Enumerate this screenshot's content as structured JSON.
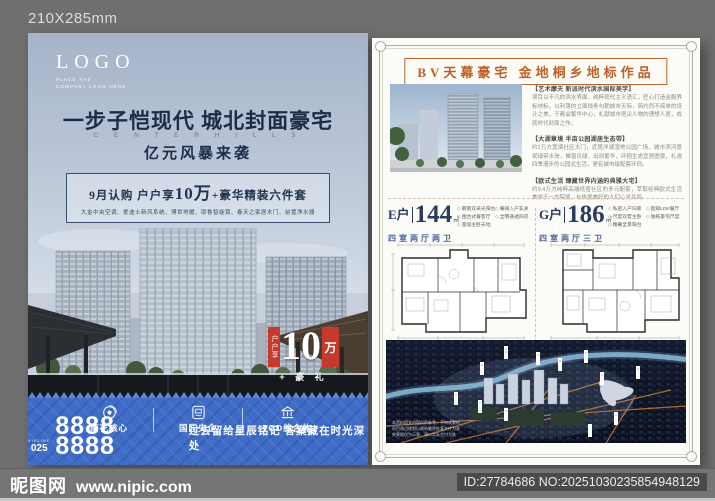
{
  "page": {
    "size_label": "210X285mm"
  },
  "watermark": {
    "brand": "昵图网",
    "url": "www.nipic.com",
    "id_text": "ID:27784686 NO:20251030235854948129"
  },
  "poster": {
    "logo": {
      "text": "LOGO",
      "sub_line1": "PLACE THE",
      "sub_line2": "COMPANY LOGO HERE"
    },
    "headline": "一步子恺现代 城北封面豪宅",
    "subhead_en": "C E N T E R  H I L L S",
    "slogan": "亿元风暴来袭",
    "offer": {
      "prefix": "9月认购 户户享",
      "big": "10万",
      "suffix": "+豪华精装六件套",
      "details": "大金中央空调、爱迪士新风系统、博世地暖、耶鲁智能锁、春天之家居木门、前置净水器"
    },
    "badge": {
      "vertical": "户户享",
      "number": "10",
      "unit": "万",
      "suffix": "+ 豪 礼"
    },
    "footer": {
      "features": [
        "雨花核心",
        "国匠央企",
        "TOD综合体"
      ],
      "hotline_label": "VIPLINE",
      "area_code": "025",
      "phone": "8888 8888",
      "tagline": "过去留给星辰铭记 答案藏在时光深处"
    }
  },
  "flyer": {
    "header": "BV天幕豪宅 金地桐乡地标作品",
    "sections": [
      {
        "title": "【艺术摩天 新派时代滨水国际美学】",
        "body": "项目以不凡的滨水界面、纯粹现代主义语汇，匠心打造金服界标地标，以利落的立面线条勾勒城市天际，简约而不简单的设计之美，于都会繁华中心，礼献城市塔尖人物的理想人居，成就时代封面之作。"
      },
      {
        "title": "【大湖章境 半亩公园湖居生态带】",
        "body": "约2万方宽境社区大门，近揽洋湖湿地公园广场、城市滨河景观绿带水岸，推窗见绿、出则繁华，环抱生态宜居图景，礼遇四季漫步的公园式生活，更有城市级配套环伺。"
      },
      {
        "title": "【欧式生活 臻藏世界内涵的典雅大宅】",
        "body": "约9.4万方纯粹高端低密社区的多元配套，萃取经典欧式生活美学于一方院境，与热爱美好的人们心灵共鸣。"
      }
    ],
    "units": [
      {
        "name": "E户",
        "area": "144",
        "area_unit": "㎡",
        "dots": "· · · · · · · ·",
        "rooms": "四室两厅两卫",
        "features": [
          "朝南双采光阳台",
          "奢阔入户玄关",
          "围合式餐客厅",
          "全明通透四房",
          "宽境主卧天地"
        ]
      },
      {
        "name": "G户",
        "area": "186",
        "area_unit": "㎡",
        "dots": "· · · · · · · ·",
        "rooms": "四室两厅三卫",
        "features": [
          "私密入户归家",
          "超级LDK餐厅",
          "尺度双套主卧",
          "独栋豪宅尺度",
          "臻奢全景阳台"
        ]
      }
    ],
    "aerial_disclaimer": [
      "本资料相关内容仅供参考，不构成要约",
      "项目周边规划以政府最终批复文件为准",
      "效果图仅为示意，请以实际交付为准"
    ]
  }
}
